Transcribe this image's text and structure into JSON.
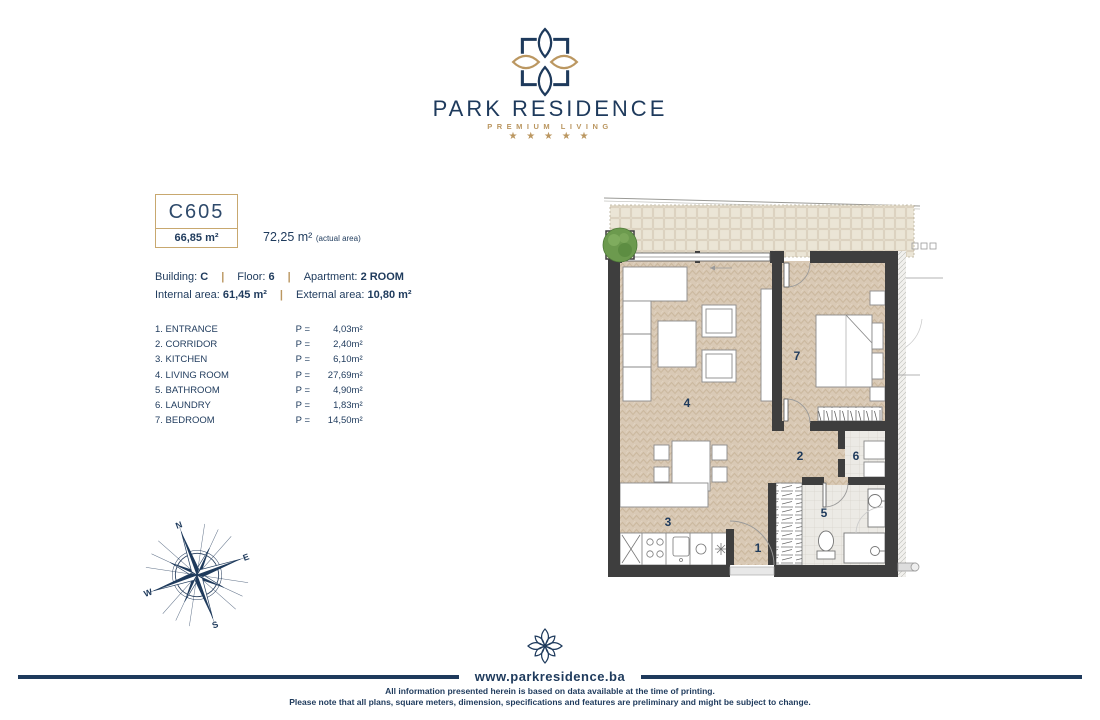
{
  "header": {
    "brand_name": "PARK RESIDENCE",
    "tagline": "PREMIUM LIVING",
    "stars": "★ ★ ★ ★ ★"
  },
  "unit": {
    "code": "C605",
    "gross_area": "66,85 m²",
    "actual_area": "72,25 m²",
    "actual_area_note": "(actual area)",
    "building_label": "Building:",
    "building_value": "C",
    "floor_label": "Floor:",
    "floor_value": "6",
    "apartment_label": "Apartment:",
    "apartment_value": "2 ROOM",
    "internal_label": "Internal area:",
    "internal_value": "61,45 m²",
    "external_label": "External area:",
    "external_value": "10,80 m²",
    "separator": "|"
  },
  "rooms": [
    {
      "label": "1. ENTRANCE",
      "prefix": "P =",
      "area": "4,03m²"
    },
    {
      "label": "2. CORRIDOR",
      "prefix": "P =",
      "area": "2,40m²"
    },
    {
      "label": "3. KITCHEN",
      "prefix": "P =",
      "area": "6,10m²"
    },
    {
      "label": "4. LIVING ROOM",
      "prefix": "P =",
      "area": "27,69m²"
    },
    {
      "label": "5. BATHROOM",
      "prefix": "P =",
      "area": "4,90m²"
    },
    {
      "label": "6. LAUNDRY",
      "prefix": "P =",
      "area": "1,83m²"
    },
    {
      "label": "7. BEDROOM",
      "prefix": "P =",
      "area": "14,50m²"
    }
  ],
  "plan": {
    "room_numbers": {
      "r1": "1",
      "r2": "2",
      "r3": "3",
      "r4": "4",
      "r5": "5",
      "r6": "6",
      "r7": "7"
    }
  },
  "compass": {
    "n": "N",
    "e": "E",
    "s": "S",
    "w": "W"
  },
  "footer": {
    "website": "www.parkresidence.ba",
    "disclaimer_line1": "All information presented herein is based on data available at the time of printing.",
    "disclaimer_line2": "Please note that all plans, square meters, dimension, specifications and features are preliminary and might be subject to change."
  },
  "colors": {
    "navy": "#1e3a5c",
    "gold": "#bb9761",
    "wall": "#3e3e3e",
    "floor": "#d9c9b5"
  }
}
